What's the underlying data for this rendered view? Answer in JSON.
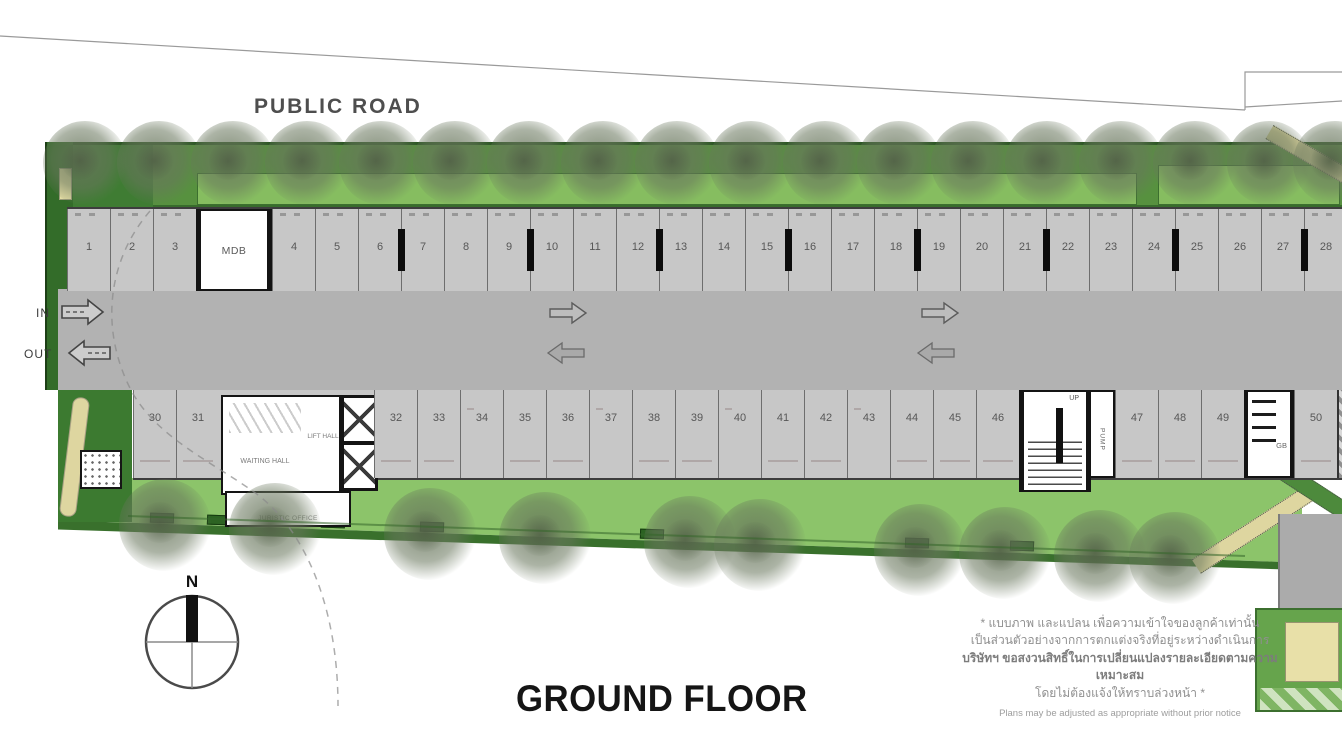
{
  "road_label": "PUBLIC ROAD",
  "title": "GROUND FLOOR",
  "north_label": "N",
  "entry": {
    "in": "IN",
    "out": "OUT"
  },
  "rooms": {
    "mdb": "MDB",
    "waiting_hall": "WAITING HALL",
    "lift_hall": "LIFT HALL",
    "juristic_office": "JURISTIC OFFICE",
    "stair_up": "UP",
    "pump": "PUMP",
    "garbage": "GB"
  },
  "parking": {
    "top_before_mdb": [
      "1",
      "2",
      "3"
    ],
    "top_after_mdb": [
      "4",
      "5",
      "6",
      "7",
      "8",
      "9",
      "10",
      "11",
      "12",
      "13",
      "14",
      "15",
      "16",
      "17",
      "18",
      "19",
      "20",
      "21",
      "22",
      "23",
      "24",
      "25",
      "26",
      "27",
      "28",
      "29"
    ],
    "bottom_start": [
      "30",
      "31"
    ],
    "bottom_mid": [
      "32",
      "33",
      "34",
      "35",
      "36",
      "37",
      "38",
      "39",
      "40",
      "41",
      "42",
      "43",
      "44",
      "45",
      "46"
    ],
    "bottom_after_stair": [
      "47",
      "48",
      "49"
    ],
    "bottom_last": [
      "50"
    ]
  },
  "disclaimer": {
    "line1": "* แบบภาพ และแปลน เพื่อความเข้าใจของลูกค้าเท่านั้น",
    "line2": "เป็นส่วนตัวอย่างจากการตกแต่งจริงที่อยู่ระหว่างดำเนินการ",
    "line3": "บริษัทฯ ขอสงวนสิทธิ์ในการเปลี่ยนแปลงรายละเอียดตามความเหมาะสม",
    "line4": "โดยไม่ต้องแจ้งให้ทราบล่วงหน้า *",
    "line5": "Plans may be adjusted as appropriate without prior notice"
  },
  "colors": {
    "lawn_green": "#8cc46a",
    "strip_green": "#57913f",
    "dark_green": "#336c29",
    "driveway_gray": "#b2b2b2",
    "stall_gray": "#c7c7c7",
    "tan_path": "#ded6a0"
  }
}
